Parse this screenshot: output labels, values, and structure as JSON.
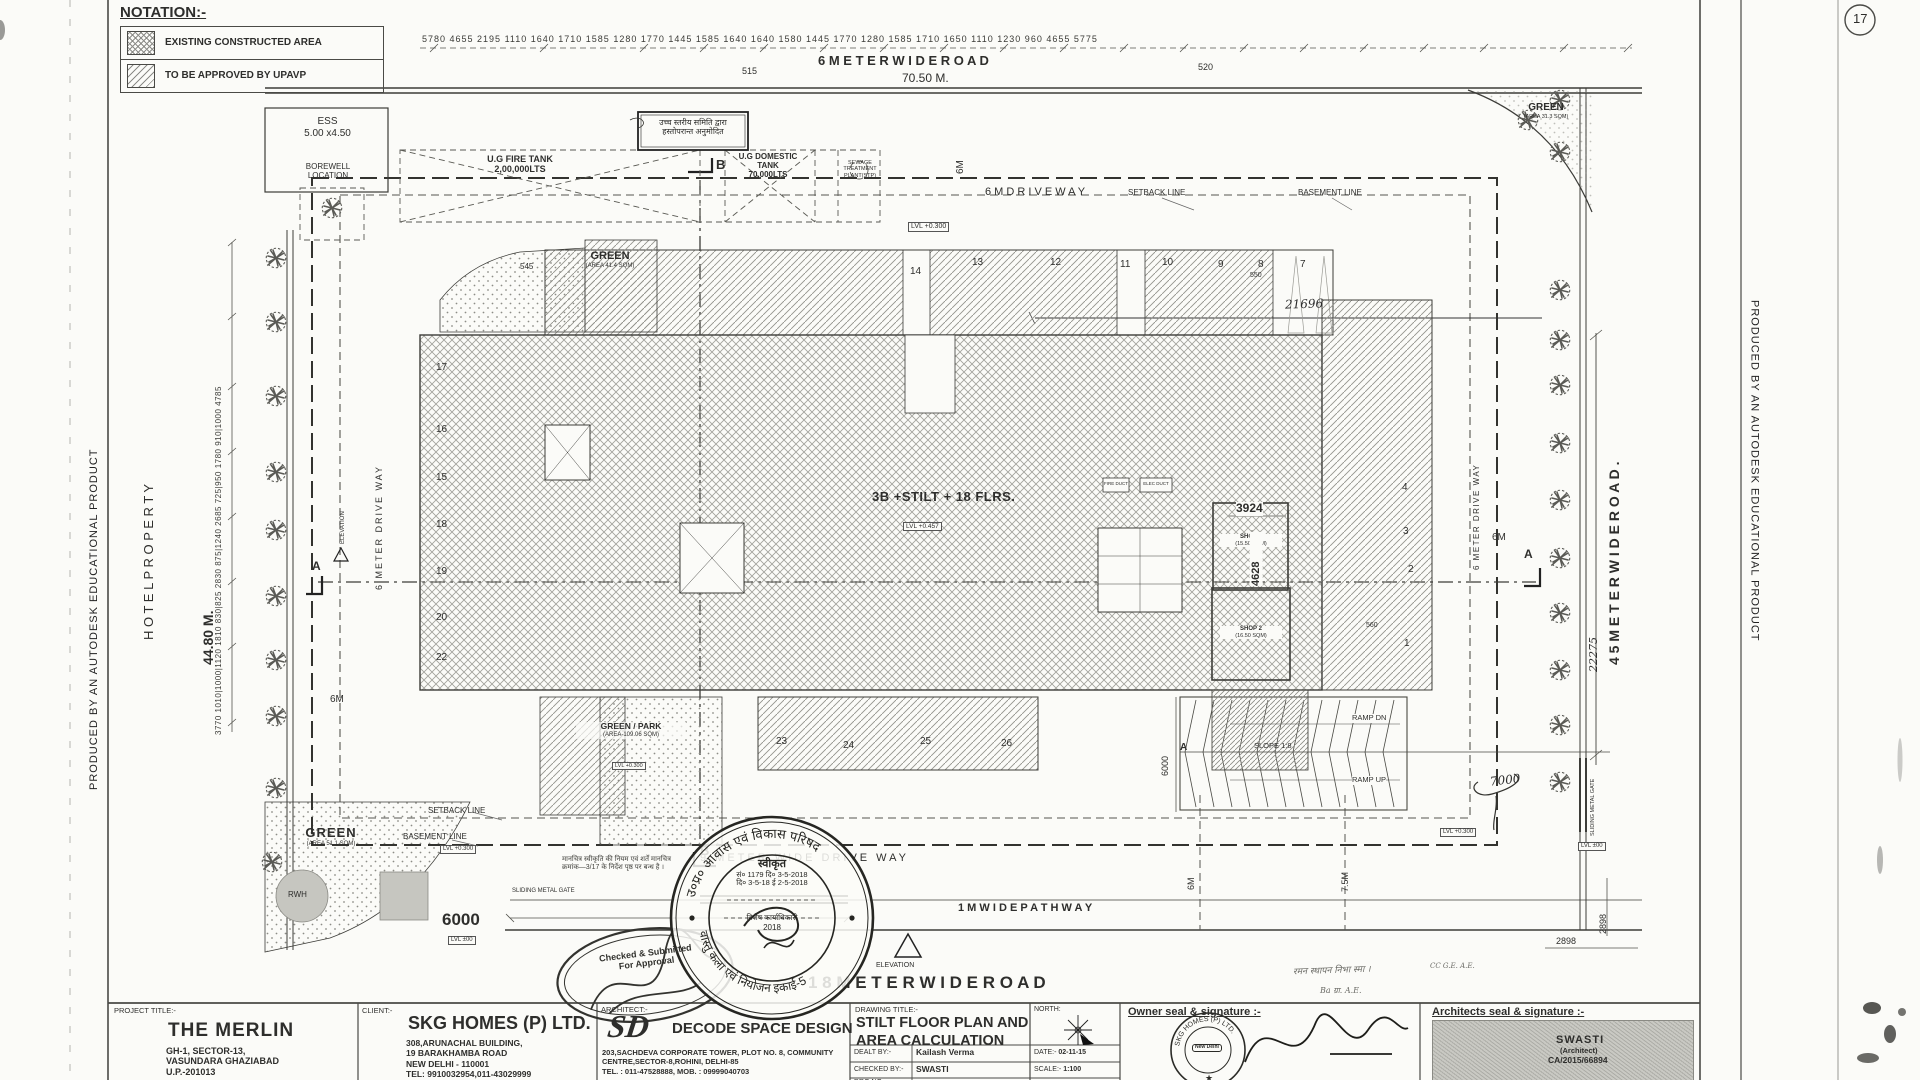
{
  "page": {
    "number": "17"
  },
  "watermark": "PRODUCED BY AN AUTODESK EDUCATIONAL PRODUCT",
  "notation": {
    "title": "NOTATION:-",
    "items": [
      {
        "label": "EXISTING CONSTRUCTED AREA"
      },
      {
        "label": "TO BE APPROVED BY UPAVP"
      }
    ]
  },
  "roads": {
    "top_name": "6   M E T E R   W I D E   R O A D",
    "top_length": "70.50 M.",
    "bottom_name": "1 8  M E T E R   W I D E   R O A D",
    "right_name": "4 5  M E T E R   W I D E   R O A D .",
    "pathway": "1 M   W I D E   P A T H W A Y",
    "drive_top": "6 M   D R I V E   W A Y",
    "drive_bottom": "9 METER WIDE DRIVE WAY",
    "drive_left": "6 METER DRIVE WAY",
    "drive_right": "6 METER DRIVE WAY"
  },
  "site": {
    "hotel": "H O T E L   P R O P E R T Y",
    "left_total": "44.80 M.",
    "ess_1": "ESS",
    "ess_2": "5.00 x4.50",
    "borewell_1": "BOREWELL",
    "borewell_2": "LOCATION",
    "setback": "SETBACK LINE",
    "basement": "BASEMENT LINE",
    "sliding_gate": "SLIDING METAL GATE"
  },
  "tanks": {
    "fire_1": "U.G FIRE TANK",
    "fire_2": "2,00,000LTS",
    "dom_1": "U.G DOMESTIC",
    "dom_2": "TANK",
    "dom_3": "70,000LTS",
    "stp_1": "SEWAGE",
    "stp_2": "TREATMENT",
    "stp_3": "PLANT(STP)"
  },
  "building": {
    "label": "3B +STILT + 18 FLRS.",
    "level": "LVL +0.457",
    "fire_duct": "FIRE DUCT",
    "elec_duct": "ELEC DUCT",
    "shop1_1": "SHOP 1",
    "shop1_2": "(15.50 SQM)",
    "shop2_1": "SHOP 2",
    "shop2_2": "(16.50 SQM)"
  },
  "greens": {
    "g1_1": "GREEN",
    "g1_2": "(AREA 41.4 SQM)",
    "g2_1": "GREEN",
    "g2_2": "(AREA 31.3 SQM)",
    "g3_1": "GREEN / PARK",
    "g3_2": "(AREA-109.06 SQM)",
    "g4_1": "GREEN",
    "g4_2": "(AREA 51.1 SQM)",
    "rwh": "RWH"
  },
  "ramp": {
    "dn": "RAMP DN",
    "up": "RAMP UP",
    "slope": "SLOPE 1:8"
  },
  "levels": {
    "l300": "LVL +0.300",
    "l0": "LVL ±00"
  },
  "dims": {
    "top": [
      "5780",
      "4655",
      "2195",
      "1110",
      "1640",
      "1710",
      "1585",
      "1280",
      "1770",
      "1445",
      "1585",
      "1640",
      "1640",
      "1580",
      "1445",
      "1770",
      "1280",
      "1585",
      "1710",
      "1650",
      "1110",
      "1230",
      "960",
      "4655",
      "5775"
    ],
    "sub_515": "515",
    "sub_520": "520",
    "left_bottom_to_top": [
      "3770",
      "1010|1000|1120",
      "1810",
      "830|825",
      "2830",
      "875|1240",
      "2685",
      "725|950",
      "1780",
      "910|1000",
      "4785"
    ],
    "d545": "545",
    "d550": "550",
    "d560": "560",
    "d3924": "3924",
    "d4628": "4628",
    "d6000_ramp": "6000",
    "d6000_gate": "6000",
    "d2898": "2898",
    "d75m": "7.5M",
    "d6m": "6M",
    "hand_21696": "21696",
    "hand_22275": "22275",
    "hand_7000": "7000"
  },
  "units": {
    "top": [
      "14",
      "13",
      "12",
      "11",
      "10",
      "9",
      "8",
      "7"
    ],
    "left": [
      "17",
      "16",
      "15",
      "18",
      "19",
      "20",
      "22"
    ],
    "bottom": [
      "23",
      "24",
      "25",
      "26"
    ],
    "right": [
      "4",
      "3",
      "2",
      "1"
    ]
  },
  "markers": {
    "a": "A",
    "b": "B",
    "elevation": "ELEVATION",
    "elevation_no": "1"
  },
  "stamps": {
    "oval_1": "Checked & Submitted",
    "oval_2": "For Approval",
    "hindi_box_1": "उच्च स्तरीय समिति द्वारा",
    "hindi_box_2": "हस्तोपरान्त अनुमोदित",
    "hindi_note_1": "मानचित्र स्वीकृति की नियम एवं शर्तें मानचित्र",
    "hindi_note_2": "क्रमांक—3/17 के निर्देश पृष्ठ पर बन्ध है ।",
    "round_top": "उ०प्र० आवास एवं विकास परिषद",
    "round_bottom": "वास्तु कला एवं नियोजन इकाई-5",
    "round_c1": "स्वीकृत",
    "round_c2": "सं० 1179   दि० 3-5-2018",
    "round_c3": "दि० 3-5-18  ई  2-5-2018",
    "round_c4": "विशेष कार्याधिकारी",
    "round_c5": "2018",
    "pencil_1": "रमन स्थापन निभा स्मा ।",
    "pencil_2": "Ba    ग्रा.    A.E.",
    "pencil_3": "CC  G.E.  A.E."
  },
  "titleblock": {
    "project": {
      "label": "PROJECT  TITLE:-",
      "name": "THE MERLIN",
      "addr1": "GH-1, SECTOR-13,",
      "addr2": "VASUNDARA GHAZIABAD",
      "addr3": "U.P.-201013"
    },
    "client": {
      "label": "CLIENT:-",
      "name": "SKG HOMES (P) LTD.",
      "addr1": "308,ARUNACHAL BUILDING,",
      "addr2": "19 BARAKHAMBA ROAD",
      "addr3": "NEW DELHI - 110001",
      "addr4": "TEL: 9910032954,011-43029999",
      "addr5": "FAX: 011-43029930"
    },
    "architect": {
      "label": "ARCHITECT:-",
      "logo": "SD",
      "name": "DECODE SPACE DESIGN",
      "addr1": "203,SACHDEVA CORPORATE TOWER, PLOT NO. 8, COMMUNITY",
      "addr2": "CENTRE,SECTOR-8,ROHINI, DELHI-85",
      "addr3": "TEL. : 011-47528888, MOB. : 09999040703"
    },
    "drawing": {
      "label": "DRAWING  TITLE:-",
      "title1": "STILT FLOOR PLAN AND",
      "title2": "AREA CALCULATION",
      "dealt_label": "DEALT  BY:-",
      "dealt": "Kailash Verma",
      "checked_label": "CHECKED  BY:-",
      "checked": "SWASTI",
      "drg_label": "DRG NO:-",
      "north_label": "NORTH:",
      "date_label": "DATE:-",
      "date": "02-11-15",
      "scale_label": "SCALE:-",
      "scale": "1:100"
    },
    "owner_seal": {
      "label": "Owner seal & signature :-",
      "seal_ring": "SKG HOMES (P) LTD.",
      "seal_center": "New Delhi"
    },
    "arch_seal": {
      "label": "Architects seal & signature :-",
      "name": "SWASTI",
      "role": "(Architect)",
      "reg": "CA/2015/66894"
    }
  }
}
